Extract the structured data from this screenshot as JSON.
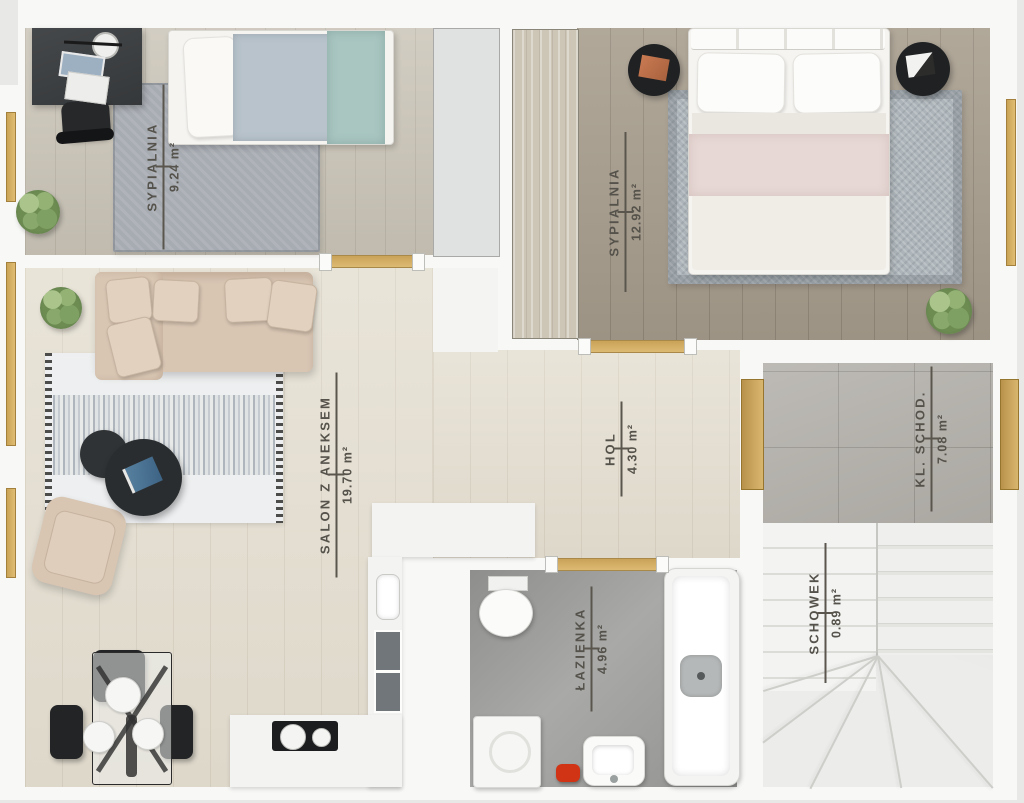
{
  "meta": {
    "title": "Apartment floor plan (top-down render)",
    "language": "Polish",
    "labels_rotated_degrees": -90
  },
  "colors": {
    "background": "#e8e8e6",
    "wall": "#f8f8f6",
    "gold_accent": "#cda55a",
    "label_text": "#55524b",
    "wood_light": "#e5dfd1",
    "wood_medium": "#cbc5b8",
    "wood_dark": "#a89e8e",
    "bathroom_tile": "#9e9e9c",
    "landing_tile": "#b4b1ab",
    "stairs": "#ececea"
  },
  "rooms": [
    {
      "name": "SYPIALNIA",
      "area": "9.24 m²"
    },
    {
      "name": "SYPIALNIA",
      "area": "12.92 m²"
    },
    {
      "name": "SALON Z ANEKSEM",
      "area": "19.70 m²"
    },
    {
      "name": "HOL",
      "area": "4.30 m²"
    },
    {
      "name": "ŁAZIENKA",
      "area": "4.96 m²"
    },
    {
      "name": "KL. SCHOD.",
      "area": "7.08 m²"
    },
    {
      "name": "SCHOWEK",
      "area": "0.89 m²"
    }
  ]
}
